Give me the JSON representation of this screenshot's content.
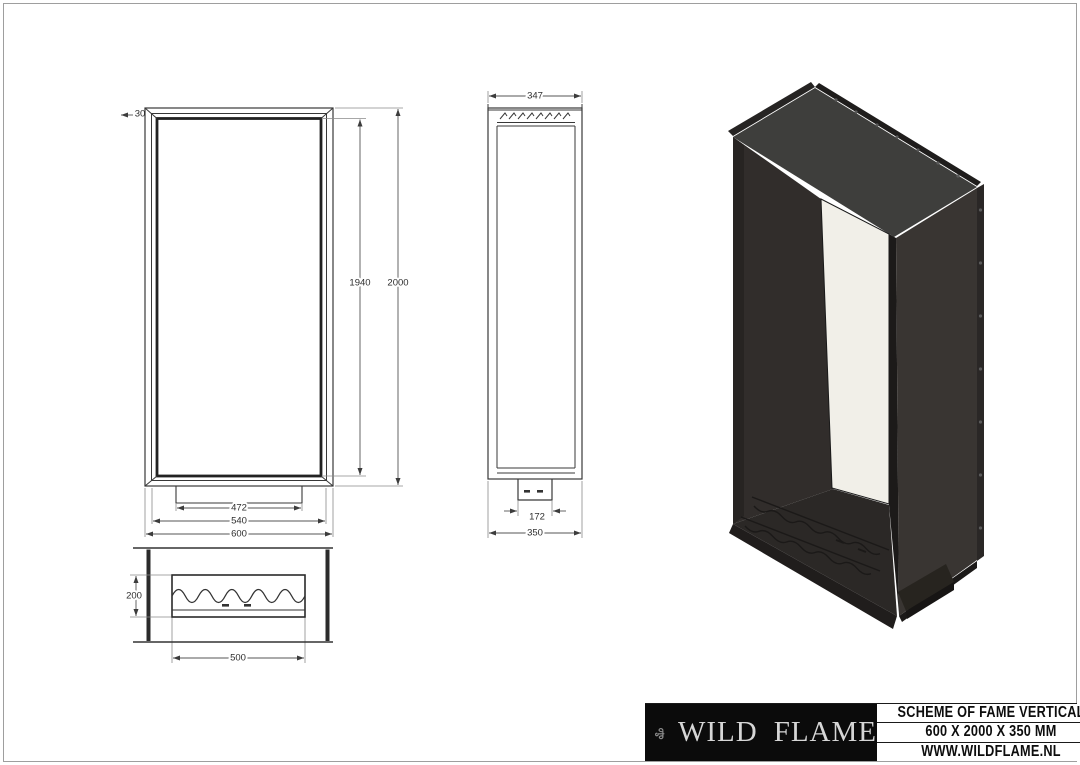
{
  "dimensions": {
    "front_flange": "30",
    "front_inner_height": "1940",
    "front_height": "2000",
    "front_burner_width": "472",
    "front_tray_width": "540",
    "front_width": "600",
    "side_top_depth": "347",
    "side_tray_depth": "172",
    "side_depth": "350",
    "bottom_depth": "200",
    "bottom_burner_length": "500"
  },
  "title_block": {
    "brand_word1": "WILD",
    "brand_word2": "FLAME",
    "rows": [
      {
        "label": "SCHEME OF FAME VERTICAL"
      },
      {
        "label": "600 X 2000 X 350 MM"
      },
      {
        "label": "WWW.WILDFLAME.NL"
      }
    ]
  },
  "colors": {
    "line": "#3c3c3c",
    "dim_line": "#6b6b6b",
    "body_dark": "#3e3e3c",
    "panel_white": "#f1efe8",
    "logo_gray": "#8d8d8d",
    "block_black": "#0b0b0b"
  }
}
